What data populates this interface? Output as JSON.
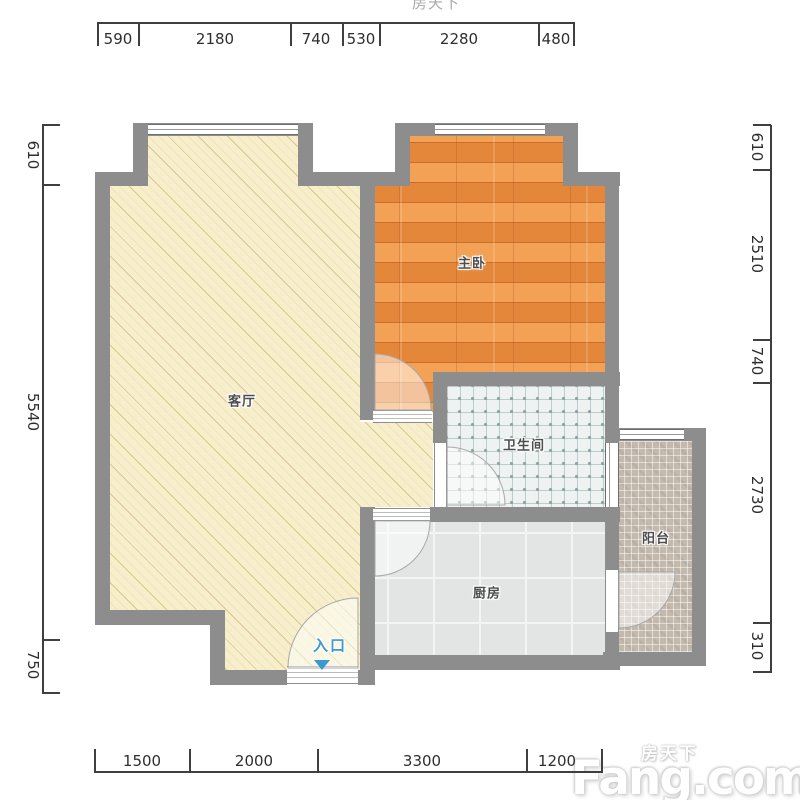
{
  "watermark": {
    "brand_cn": "房天下",
    "brand_en": "Fang.com"
  },
  "watermark_top": {
    "text": "房天下"
  },
  "rooms": {
    "living": {
      "label": "客厅"
    },
    "bedroom": {
      "label": "主卧"
    },
    "bathroom": {
      "label": "卫生间"
    },
    "kitchen": {
      "label": "厨房"
    },
    "balcony": {
      "label": "阳台"
    }
  },
  "entrance": {
    "label": "入口"
  },
  "dimensions_mm": {
    "top": [
      "590",
      "2180",
      "740",
      "530",
      "2280",
      "480"
    ],
    "left": [
      "610",
      "5540",
      "750"
    ],
    "right": [
      "610",
      "2510",
      "740",
      "2730",
      "310"
    ],
    "bottom": [
      "1500",
      "2000",
      "3300",
      "1200"
    ]
  },
  "colors": {
    "wall": "#8d8d8d",
    "living_floor": "#f7eecb",
    "bedroom_floor": "#e98e40",
    "bathroom_floor": "#eef2f1",
    "kitchen_floor": "#e3e5e5",
    "balcony_floor": "#c3b9ad",
    "entrance_accent": "#3a99cf",
    "dimension_text": "#2e2e2e"
  }
}
